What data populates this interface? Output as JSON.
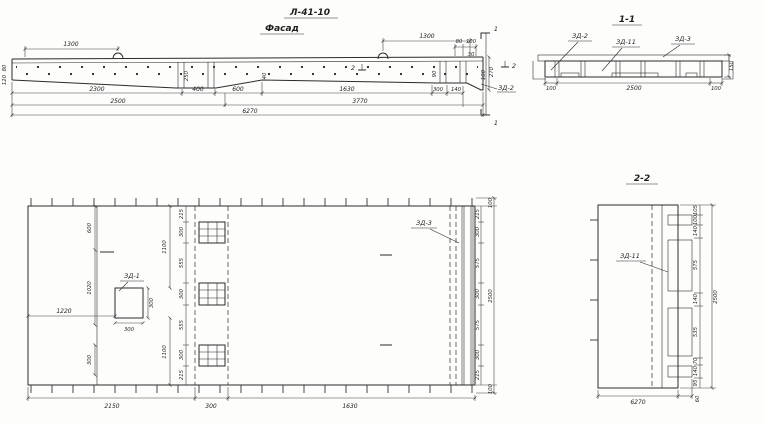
{
  "drawing": {
    "title": "Л-41-10",
    "elevation": {
      "subtitle": "Фасад",
      "dim_1300_left": "1300",
      "dim_1300_right": "1300",
      "dim_80_top": "80",
      "dim_100_top": "100",
      "dim_30": "30",
      "dim_270_right": "270",
      "dim_100_right": "100",
      "dim_80_left": "80",
      "dim_120_left": "120",
      "dim_250": "250",
      "dim_40": "40",
      "dim_90": "90",
      "row1": [
        "2300",
        "400",
        "600",
        "1630",
        "300",
        "140"
      ],
      "row2": [
        "2500",
        "3770"
      ],
      "total": "6270",
      "zd2_label": "ЗД-2",
      "mark_1": "1",
      "mark_2": "2"
    },
    "section_1_1": {
      "title": "1-1",
      "zd2": "ЗД-2",
      "zd11": "ЗД-11",
      "zd3": "ЗД-3",
      "dims_bottom": [
        "100",
        "2500",
        "100"
      ],
      "dim_height": "150"
    },
    "plan": {
      "zd1": "ЗД-1",
      "zd3": "ЗД-3",
      "col_left": [
        "600",
        "1020",
        "300"
      ],
      "col_mid": [
        "1100",
        "1100"
      ],
      "box_height": "300",
      "box_width": "300",
      "dim_1220": "1220",
      "col_strip": [
        "215",
        "300",
        "555",
        "300",
        "555",
        "300",
        "215"
      ],
      "col_right_inner": [
        "215",
        "300",
        "575",
        "300",
        "575",
        "300",
        "215"
      ],
      "col_right_outer": [
        "100",
        "2500",
        "100"
      ],
      "dims_bottom": [
        "2150",
        "300",
        "1630"
      ]
    },
    "section_2_2": {
      "title": "2-2",
      "zd11": "ЗД-11",
      "col_right": [
        "105",
        "100",
        "140",
        "575",
        "140",
        "535",
        "70",
        "140",
        "95"
      ],
      "dim_overall": "2500",
      "dim_bottom": "6270",
      "dim_60": "60"
    }
  }
}
